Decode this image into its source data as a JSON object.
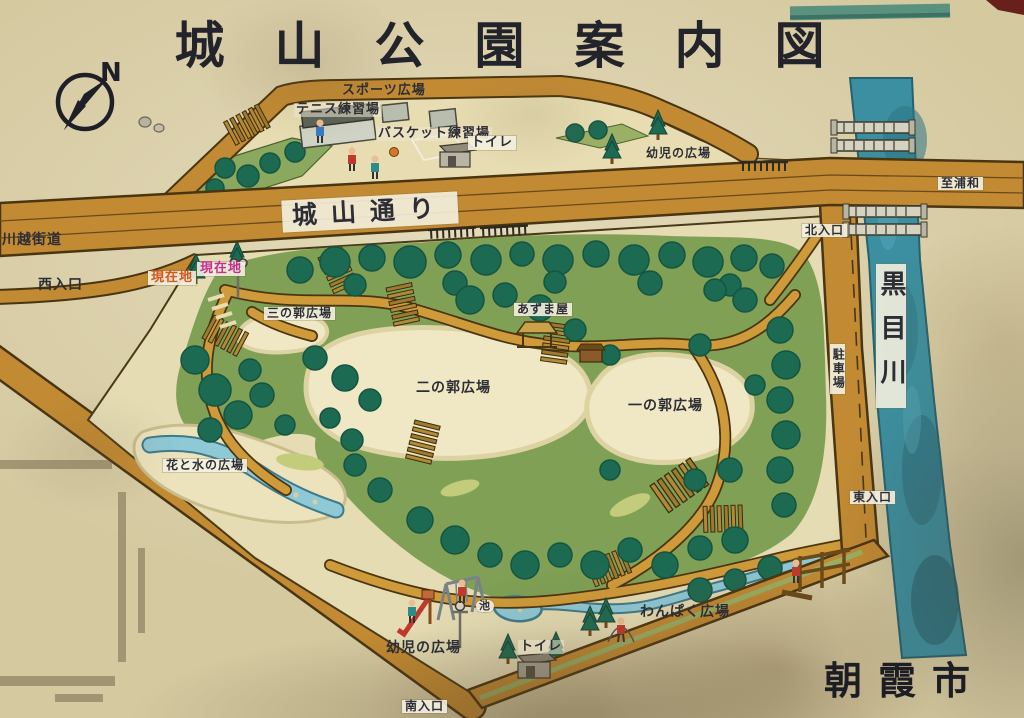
{
  "sign": {
    "title": "城山公園案内図",
    "city": "朝霞市",
    "compass_label": "N"
  },
  "roads": {
    "main_street": "城山通り",
    "highway": "川越街道",
    "to_urawa": "至浦和"
  },
  "river": {
    "name": "黒目川"
  },
  "entrances": {
    "west": "西入口",
    "north": "北入口",
    "east": "東入口",
    "south": "南入口"
  },
  "markers": {
    "current_1": "現在地",
    "current_2": "現在地"
  },
  "areas": {
    "sports": "スポーツ広場",
    "tennis": "テニス練習場",
    "basketball": "バスケット練習場",
    "toddlers_north": "幼児の広場",
    "third_bailey": "三の郭広場",
    "azumaya": "あずま屋",
    "second_bailey": "二の郭広場",
    "first_bailey": "一の郭広場",
    "parking": "駐車場",
    "flower_water": "花と水の広場",
    "wanpaku": "わんぱく広場",
    "toddlers_south": "幼児の広場",
    "pond": "池"
  },
  "toilets": {
    "north": "トイレ",
    "south": "トイレ"
  },
  "colors": {
    "road_ochre": "#c28a33",
    "park_green": "#7fa055",
    "tree_green": "#1d6a52",
    "river_teal": "#3b8fa0",
    "stream_blue": "#8fc9d6",
    "plaza_cream": "#f0e8c4",
    "sign_beige": "#d5c9a0",
    "marker_orange": "#d2571e",
    "marker_magenta": "#c42e8c"
  }
}
